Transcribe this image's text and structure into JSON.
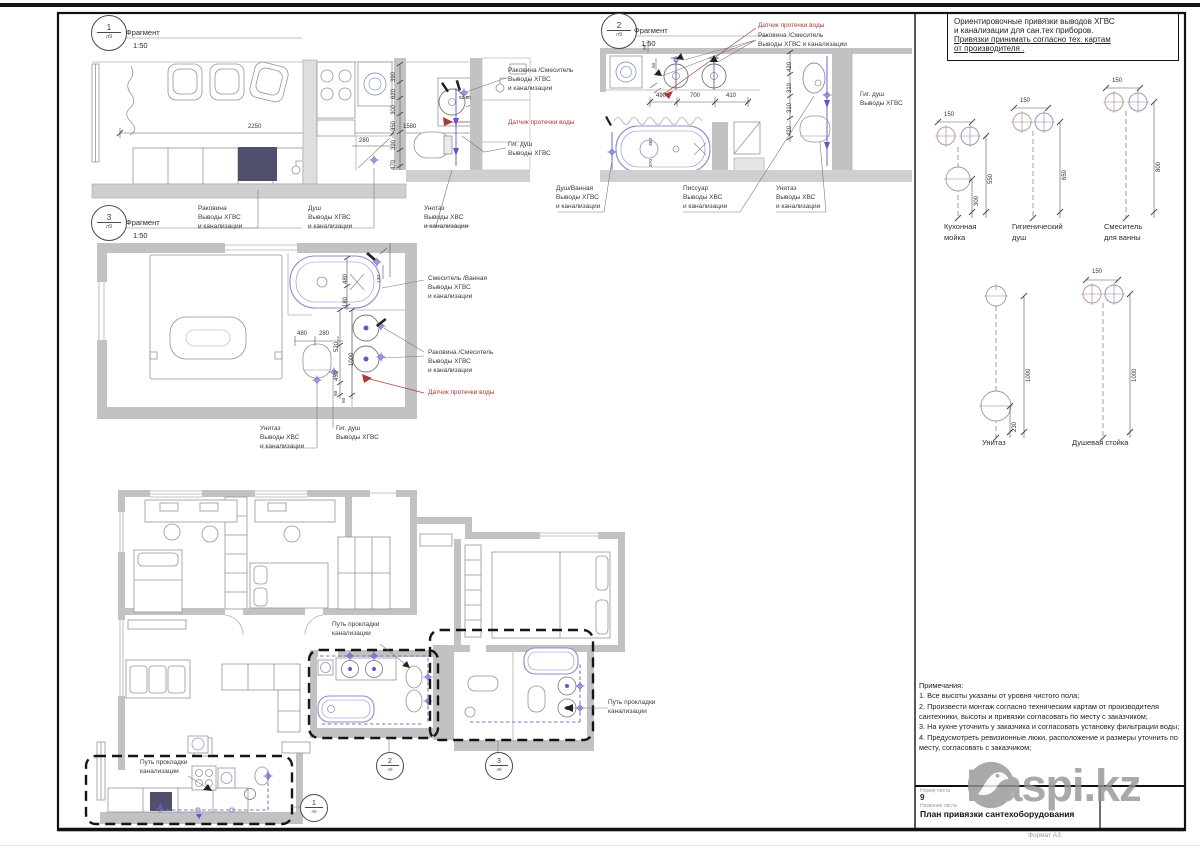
{
  "fragments": {
    "f1": {
      "num": "1",
      "sub": "л9",
      "title": "Фрагмент",
      "scale": "1:50"
    },
    "f2": {
      "num": "2",
      "sub": "л9",
      "title": "Фрагмент",
      "scale": "1:50"
    },
    "f3": {
      "num": "3",
      "sub": "л9",
      "title": "Фрагмент",
      "scale": "1:50"
    }
  },
  "refs": {
    "r1": {
      "num": "1",
      "sub": "л9"
    },
    "r2": {
      "num": "2",
      "sub": "л9"
    },
    "r3": {
      "num": "3",
      "sub": "л9"
    }
  },
  "callouts": {
    "sink": "Раковина\nВыводы ХГВС\nи канализации",
    "shower": "Душ\nВыводы ХГВС\nи канализации",
    "wc_cold": "Унитаз\nВыводы ХВС\nи канализации",
    "sink_mixer": "Раковина /Смеситель\nВыводы ХГВС\nи канализации",
    "sink_mixer_inline": "Раковина /Смеситель\nВыводы ХГВС и канализации",
    "leak": "Датчик протечки воды",
    "gig": "Гиг. душ\nВыводы ХГВС",
    "bath_shower": "Душ/Ванная\nВыводы ХГВС\nи канализации",
    "urinal": "Писсуар\nВыводы ХВС\nи канализации",
    "mixer_bath": "Смеситель /Ванная\nВыводы ХГВС\nи канализации",
    "path": "Путь прокладки\nканализации"
  },
  "dims": {
    "f1": [
      "2250",
      "1580",
      "280",
      "390",
      "620",
      "300",
      "350",
      "390",
      "470",
      "50 50"
    ],
    "f2": [
      "490",
      "700",
      "410",
      "420",
      "310",
      "310",
      "420",
      "360",
      "370",
      "50",
      "50"
    ],
    "f3": [
      "480",
      "180",
      "130",
      "480",
      "280",
      "1000",
      "520",
      "450",
      "50",
      "50"
    ]
  },
  "fixtures": [
    {
      "name": "Кухонная\nмойка",
      "w": "150",
      "d1": "550",
      "d2": "300"
    },
    {
      "name": "Гигиенический\nдуш",
      "w": "150",
      "d1": "650"
    },
    {
      "name": "Смеситель\nдля ванны",
      "w": "150",
      "d1": "800"
    },
    {
      "name": "Унитаз",
      "d1": "1000",
      "d2": "230"
    },
    {
      "name": "Душевая стойка",
      "w": "150",
      "d1": "1000"
    }
  ],
  "header_note": {
    "l1": "Ориентировочные привязки выводов ХГВС",
    "l2": "и канализации для сан.тех приборов.",
    "l3": "Привязки принимать согласно тех. картам",
    "l4": "от производителя ."
  },
  "notes": {
    "title": "Примечания:",
    "n1": "1.  Все высоты указаны от уровня чистого пола;",
    "n2": "2.  Произвести монтаж согласно техническим картам от производителя сантехники, высоты и привязки согласовать по месту с заказчиком;",
    "n3": "3.  На кухне уточнить у заказчика и согласовать установку фильтрации воды;",
    "n4": "4.  Предусмотреть ревизионные люки, расположение и размеры уточнить по месту, согласовать с заказчиком;"
  },
  "titleblock": {
    "number_label": "Номер листа",
    "number": "9",
    "name_label": "Название листа",
    "name": "План привязки сантехоборудования"
  },
  "format": "Формат А3",
  "watermark": {
    "text": "Kaspi.kz"
  }
}
